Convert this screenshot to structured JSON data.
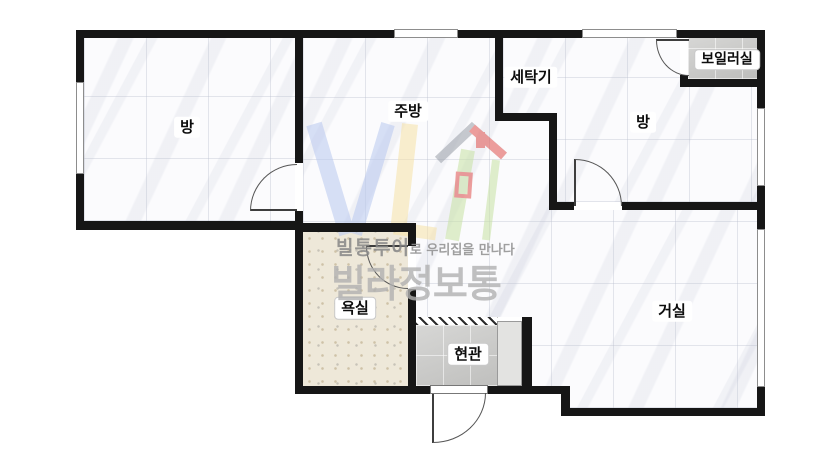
{
  "floorplan": {
    "rooms": [
      {
        "id": "bedroom-left",
        "label": "방",
        "floor": "marble-tile"
      },
      {
        "id": "kitchen",
        "label": "주방",
        "floor": "marble-tile"
      },
      {
        "id": "laundry",
        "label": "세탁기",
        "floor": "marble-tile"
      },
      {
        "id": "bedroom-right",
        "label": "방",
        "floor": "marble-tile"
      },
      {
        "id": "boiler-room",
        "label": "보일러실",
        "floor": "gray-tile"
      },
      {
        "id": "bathroom",
        "label": "욕실",
        "floor": "beige-speckle-tile"
      },
      {
        "id": "entrance",
        "label": "현관",
        "floor": "gray-tile"
      },
      {
        "id": "living-room",
        "label": "거실",
        "floor": "marble-tile"
      }
    ],
    "watermark": {
      "tagline_strong": "빌통투어",
      "tagline_rest": "로 우리집을 만나다",
      "brand": "빌라정보통"
    },
    "colors": {
      "wall": "#161616",
      "marble_floor": "#fbfbfd",
      "bath_floor": "#eee8d9",
      "gray_floor": "#c9c9c7",
      "logo_blue": "#b9c9f0",
      "logo_yellow": "#f6e2a6",
      "logo_green": "#c7e2a4",
      "logo_red": "#e0524e",
      "logo_roof_gray": "#9aa0a8"
    }
  }
}
